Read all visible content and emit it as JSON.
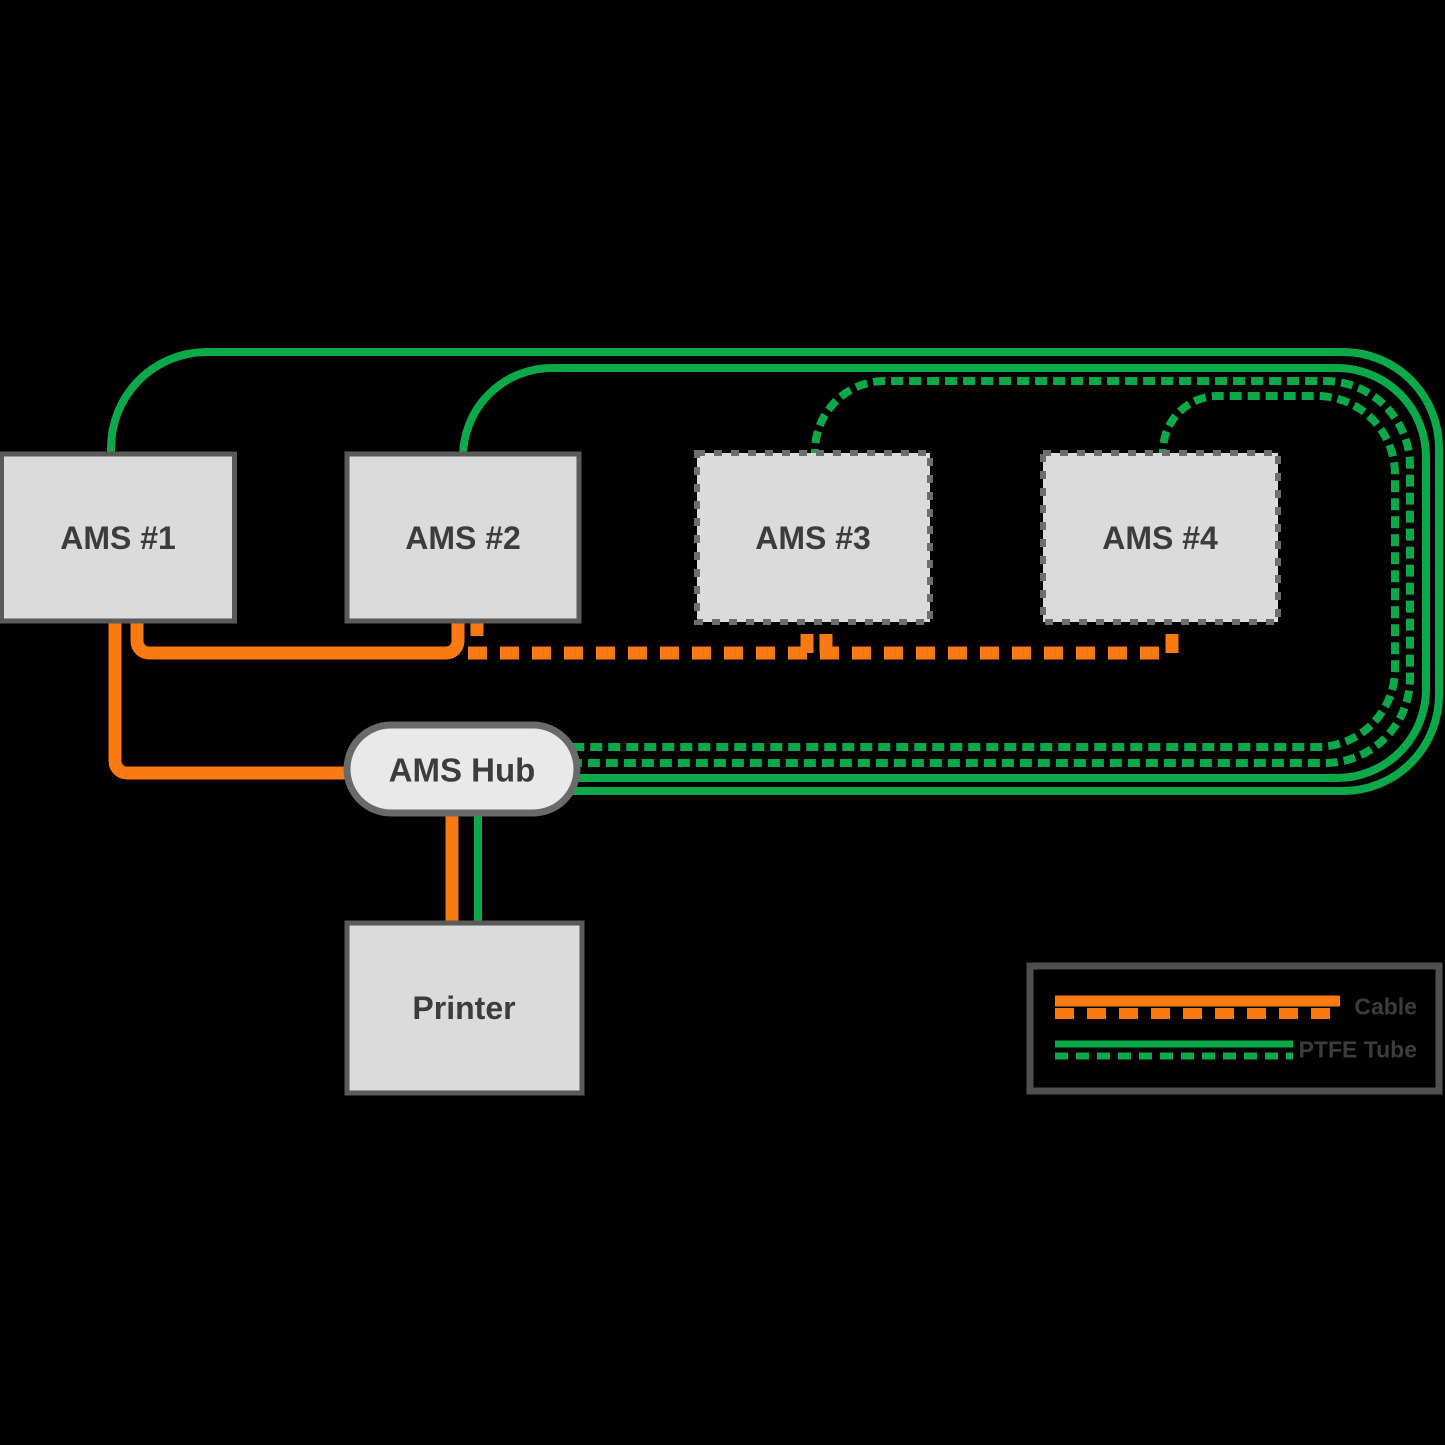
{
  "colors": {
    "background": "#000000",
    "cable": "#FA7A12",
    "tube": "#0CA94A",
    "box_fill": "#DBDBDB",
    "box_border": "#5A5A5A",
    "box_border_dashed": "#6E6E6E",
    "hub_fill": "#E9E9E9",
    "hub_border": "#6A6A6A",
    "legend_border": "#4F4F4F",
    "text": "#3C3C3C"
  },
  "nodes": {
    "ams1": {
      "label": "AMS #1"
    },
    "ams2": {
      "label": "AMS #2"
    },
    "ams3": {
      "label": "AMS #3"
    },
    "ams4": {
      "label": "AMS #4"
    },
    "hub": {
      "label": "AMS Hub"
    },
    "printer": {
      "label": "Printer"
    }
  },
  "legend": {
    "items": [
      {
        "label": "Cable"
      },
      {
        "label": "PTFE Tube"
      }
    ]
  }
}
